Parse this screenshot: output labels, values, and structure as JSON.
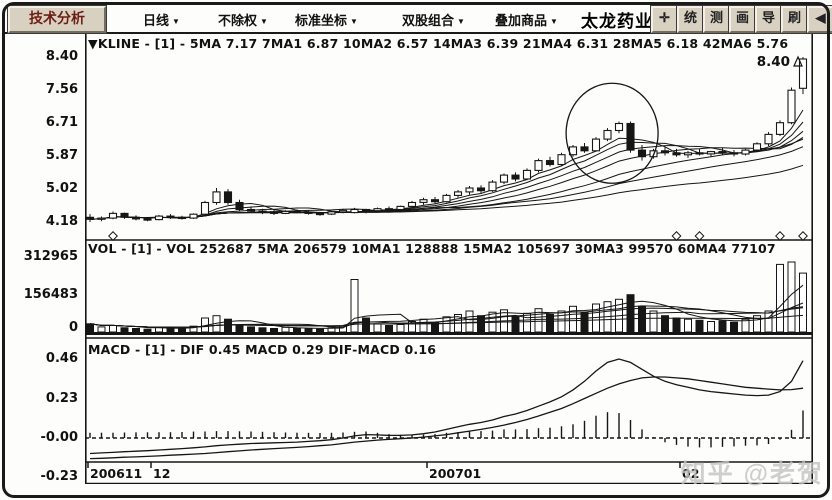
{
  "toolbar": {
    "analysis_button": "技术分析",
    "menus": [
      {
        "label": "日线",
        "arrow": "▼"
      },
      {
        "label": "不除权",
        "arrow": "▼"
      },
      {
        "label": "标准坐标",
        "arrow": "▼"
      },
      {
        "label": "双股组合",
        "arrow": "▼"
      },
      {
        "label": "叠加商品",
        "arrow": "▼"
      }
    ],
    "stock_name": "太龙药业",
    "icon_buttons": [
      {
        "name": "move-icon",
        "glyph": "✛"
      },
      {
        "name": "stats-icon",
        "glyph": "统"
      },
      {
        "name": "measure-icon",
        "glyph": "测"
      },
      {
        "name": "draw-icon",
        "glyph": "画"
      },
      {
        "name": "export-icon",
        "glyph": "导"
      },
      {
        "name": "refresh-icon",
        "glyph": "刷"
      },
      {
        "name": "collapse-icon",
        "glyph": "◀"
      }
    ]
  },
  "panes": {
    "kline": {
      "header": "▼KLINE - [1] - 5MA 7.17 7MA1 6.87 10MA2 6.57 14MA3 6.39 21MA4 6.31 28MA5 6.18 42MA6 5.76",
      "y_labels": [
        "8.40",
        "7.56",
        "6.71",
        "5.87",
        "5.02",
        "4.18"
      ]
    },
    "vol": {
      "header": "VOL - [1] - VOL 252687 5MA 206579 10MA1 128888 15MA2 105697 30MA3 99570 60MA4 77107",
      "y_labels": [
        "312965",
        "156483",
        "0"
      ]
    },
    "macd": {
      "header": "MACD - [1] - DIF 0.45 MACD 0.29 DIF-MACD 0.16",
      "y_labels": [
        "0.46",
        "0.23",
        "-0.00",
        "-0.23"
      ]
    }
  },
  "watermark": "知乎 @老贺",
  "chart_data": {
    "type": "candlestick+volume+macd",
    "x_ticks": [
      {
        "index": 0,
        "label": "200611"
      },
      {
        "index": 6,
        "label": "12"
      },
      {
        "index": 30,
        "label": "200701"
      },
      {
        "index": 52,
        "label": "02"
      }
    ],
    "kline": {
      "ylim": [
        4.18,
        8.4
      ],
      "y_ticks": [
        8.4,
        7.56,
        6.71,
        5.87,
        5.02,
        4.18
      ],
      "ma_periods": [
        5,
        7,
        10,
        14,
        21,
        28,
        42
      ],
      "ma_values_display": {
        "5MA": 7.17,
        "7MA1": 6.87,
        "10MA2": 6.57,
        "14MA3": 6.39,
        "21MA4": 6.31,
        "28MA5": 6.18,
        "42MA6": 5.76
      },
      "price_marker": "8.40",
      "diamond_marker_indices": [
        2,
        51,
        53,
        60,
        62
      ],
      "candles": [
        [
          4.3,
          4.38,
          4.18,
          4.25
        ],
        [
          4.25,
          4.32,
          4.2,
          4.28
        ],
        [
          4.28,
          4.45,
          4.25,
          4.4
        ],
        [
          4.4,
          4.42,
          4.26,
          4.3
        ],
        [
          4.3,
          4.35,
          4.22,
          4.26
        ],
        [
          4.26,
          4.3,
          4.2,
          4.24
        ],
        [
          4.24,
          4.36,
          4.22,
          4.33
        ],
        [
          4.33,
          4.38,
          4.26,
          4.3
        ],
        [
          4.3,
          4.34,
          4.24,
          4.28
        ],
        [
          4.28,
          4.4,
          4.26,
          4.38
        ],
        [
          4.38,
          4.72,
          4.35,
          4.68
        ],
        [
          4.68,
          5.05,
          4.62,
          4.95
        ],
        [
          4.95,
          5.02,
          4.62,
          4.68
        ],
        [
          4.68,
          4.75,
          4.45,
          4.5
        ],
        [
          4.5,
          4.58,
          4.42,
          4.46
        ],
        [
          4.46,
          4.52,
          4.38,
          4.44
        ],
        [
          4.44,
          4.5,
          4.36,
          4.4
        ],
        [
          4.4,
          4.48,
          4.38,
          4.45
        ],
        [
          4.45,
          4.5,
          4.4,
          4.43
        ],
        [
          4.43,
          4.47,
          4.37,
          4.4
        ],
        [
          4.4,
          4.44,
          4.34,
          4.38
        ],
        [
          4.38,
          4.46,
          4.36,
          4.44
        ],
        [
          4.44,
          4.52,
          4.4,
          4.48
        ],
        [
          4.42,
          4.54,
          4.4,
          4.5
        ],
        [
          4.5,
          4.52,
          4.4,
          4.47
        ],
        [
          4.47,
          4.55,
          4.43,
          4.52
        ],
        [
          4.52,
          4.58,
          4.46,
          4.5
        ],
        [
          4.5,
          4.6,
          4.48,
          4.58
        ],
        [
          4.58,
          4.72,
          4.55,
          4.68
        ],
        [
          4.68,
          4.8,
          4.62,
          4.75
        ],
        [
          4.75,
          4.82,
          4.65,
          4.7
        ],
        [
          4.7,
          4.9,
          4.68,
          4.86
        ],
        [
          4.86,
          5.0,
          4.8,
          4.95
        ],
        [
          4.95,
          5.1,
          4.88,
          5.05
        ],
        [
          5.05,
          5.12,
          4.92,
          4.98
        ],
        [
          4.98,
          5.25,
          4.95,
          5.2
        ],
        [
          5.2,
          5.42,
          5.15,
          5.38
        ],
        [
          5.38,
          5.45,
          5.22,
          5.28
        ],
        [
          5.28,
          5.55,
          5.25,
          5.5
        ],
        [
          5.5,
          5.8,
          5.45,
          5.75
        ],
        [
          5.75,
          5.85,
          5.6,
          5.65
        ],
        [
          5.65,
          5.95,
          5.62,
          5.9
        ],
        [
          5.9,
          6.15,
          5.85,
          6.1
        ],
        [
          6.1,
          6.2,
          5.95,
          6.0
        ],
        [
          6.0,
          6.35,
          5.98,
          6.3
        ],
        [
          6.3,
          6.58,
          6.25,
          6.52
        ],
        [
          6.52,
          6.75,
          6.45,
          6.7
        ],
        [
          6.7,
          6.75,
          5.95,
          6.02
        ],
        [
          6.02,
          6.15,
          5.75,
          5.85
        ],
        [
          5.85,
          6.05,
          5.8,
          6.0
        ],
        [
          6.0,
          6.1,
          5.88,
          5.95
        ],
        [
          5.95,
          6.05,
          5.85,
          5.9
        ],
        [
          5.9,
          6.0,
          5.82,
          5.95
        ],
        [
          5.95,
          6.05,
          5.88,
          5.92
        ],
        [
          5.92,
          6.0,
          5.85,
          5.98
        ],
        [
          5.98,
          6.08,
          5.9,
          5.95
        ],
        [
          5.95,
          6.02,
          5.86,
          5.92
        ],
        [
          5.92,
          6.05,
          5.88,
          6.02
        ],
        [
          6.02,
          6.22,
          5.98,
          6.18
        ],
        [
          6.18,
          6.48,
          6.12,
          6.42
        ],
        [
          6.42,
          6.78,
          6.38,
          6.72
        ],
        [
          6.72,
          7.62,
          6.68,
          7.55
        ],
        [
          7.6,
          8.4,
          7.45,
          8.35
        ]
      ]
    },
    "vol": {
      "ylim": [
        0,
        312965
      ],
      "y_ticks": [
        312965,
        156483,
        0
      ],
      "ma_periods": [
        5,
        10,
        15,
        30,
        60
      ],
      "values_display": {
        "VOL": 252687,
        "5MA": 206579,
        "10MA1": 128888,
        "15MA2": 105697,
        "30MA3": 99570,
        "60MA4": 77107
      },
      "volumes": [
        35000,
        22000,
        28000,
        18000,
        15000,
        12000,
        20000,
        18000,
        15000,
        25000,
        60000,
        70000,
        55000,
        30000,
        22000,
        18000,
        15000,
        20000,
        16000,
        14000,
        12000,
        18000,
        25000,
        225000,
        60000,
        35000,
        28000,
        32000,
        45000,
        55000,
        40000,
        65000,
        75000,
        90000,
        70000,
        85000,
        95000,
        65000,
        80000,
        100000,
        75000,
        90000,
        110000,
        85000,
        120000,
        130000,
        140000,
        160000,
        110000,
        90000,
        70000,
        60000,
        55000,
        50000,
        45000,
        48000,
        42000,
        55000,
        70000,
        90000,
        290000,
        300000,
        252687
      ]
    },
    "macd": {
      "ylim": [
        -0.23,
        0.46
      ],
      "y_ticks": [
        0.46,
        0.23,
        0.0,
        -0.23
      ],
      "values_display": {
        "DIF": 0.45,
        "MACD": 0.29,
        "DIF_MACD": 0.16
      },
      "dif": [
        -0.09,
        -0.087,
        -0.084,
        -0.08,
        -0.077,
        -0.074,
        -0.07,
        -0.066,
        -0.062,
        -0.057,
        -0.052,
        -0.045,
        -0.04,
        -0.036,
        -0.032,
        -0.03,
        -0.028,
        -0.026,
        -0.024,
        -0.02,
        -0.016,
        -0.01,
        0.0,
        0.012,
        0.02,
        0.018,
        0.015,
        0.015,
        0.018,
        0.025,
        0.035,
        0.05,
        0.065,
        0.08,
        0.09,
        0.105,
        0.125,
        0.14,
        0.16,
        0.185,
        0.21,
        0.24,
        0.28,
        0.33,
        0.39,
        0.44,
        0.46,
        0.44,
        0.4,
        0.36,
        0.33,
        0.31,
        0.295,
        0.28,
        0.27,
        0.263,
        0.256,
        0.25,
        0.247,
        0.25,
        0.27,
        0.33,
        0.45
      ],
      "dea": [
        -0.12,
        -0.118,
        -0.115,
        -0.112,
        -0.11,
        -0.107,
        -0.104,
        -0.1,
        -0.097,
        -0.094,
        -0.09,
        -0.085,
        -0.08,
        -0.075,
        -0.07,
        -0.066,
        -0.062,
        -0.058,
        -0.055,
        -0.05,
        -0.045,
        -0.04,
        -0.032,
        -0.024,
        -0.018,
        -0.012,
        -0.008,
        -0.004,
        0.0,
        0.005,
        0.012,
        0.02,
        0.03,
        0.04,
        0.05,
        0.062,
        0.075,
        0.09,
        0.108,
        0.128,
        0.15,
        0.172,
        0.2,
        0.23,
        0.26,
        0.29,
        0.315,
        0.335,
        0.35,
        0.355,
        0.355,
        0.35,
        0.345,
        0.335,
        0.325,
        0.315,
        0.305,
        0.295,
        0.29,
        0.285,
        0.28,
        0.282,
        0.29
      ]
    },
    "annotation_circle": {
      "center_index": 45.4,
      "center_price": 6.45,
      "rx_px": 46,
      "ry_px": 50
    }
  }
}
